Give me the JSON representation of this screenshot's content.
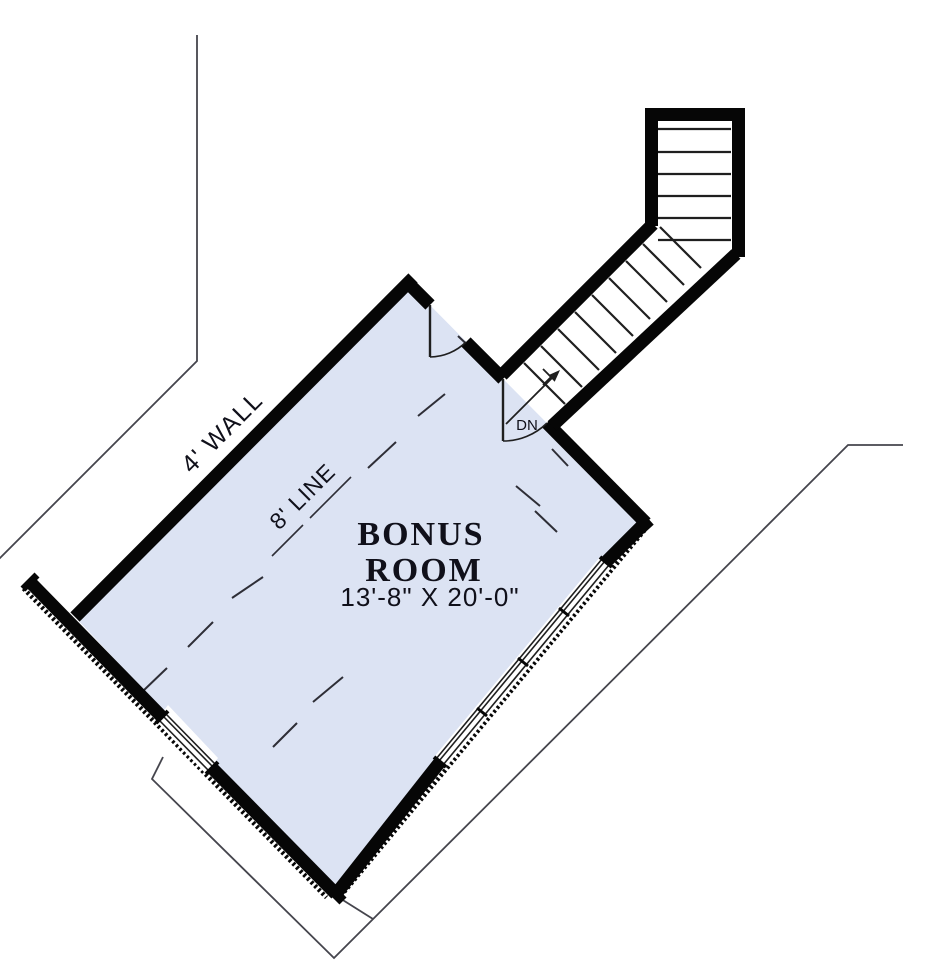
{
  "plan": {
    "room_name_line1": "BONUS",
    "room_name_line2": "ROOM",
    "room_dimensions": "13'-8\" X 20'-0\"",
    "knee_wall_label": "4' WALL",
    "ceiling_line_label": "8' LINE",
    "stair_direction_label": "DN"
  },
  "colors": {
    "room_fill": "#dce3f3",
    "wall": "#060606",
    "thin_line": "#45454d",
    "dash_line": "#2e2e36",
    "tread": "#1f1f1f",
    "text": "#10101a"
  }
}
